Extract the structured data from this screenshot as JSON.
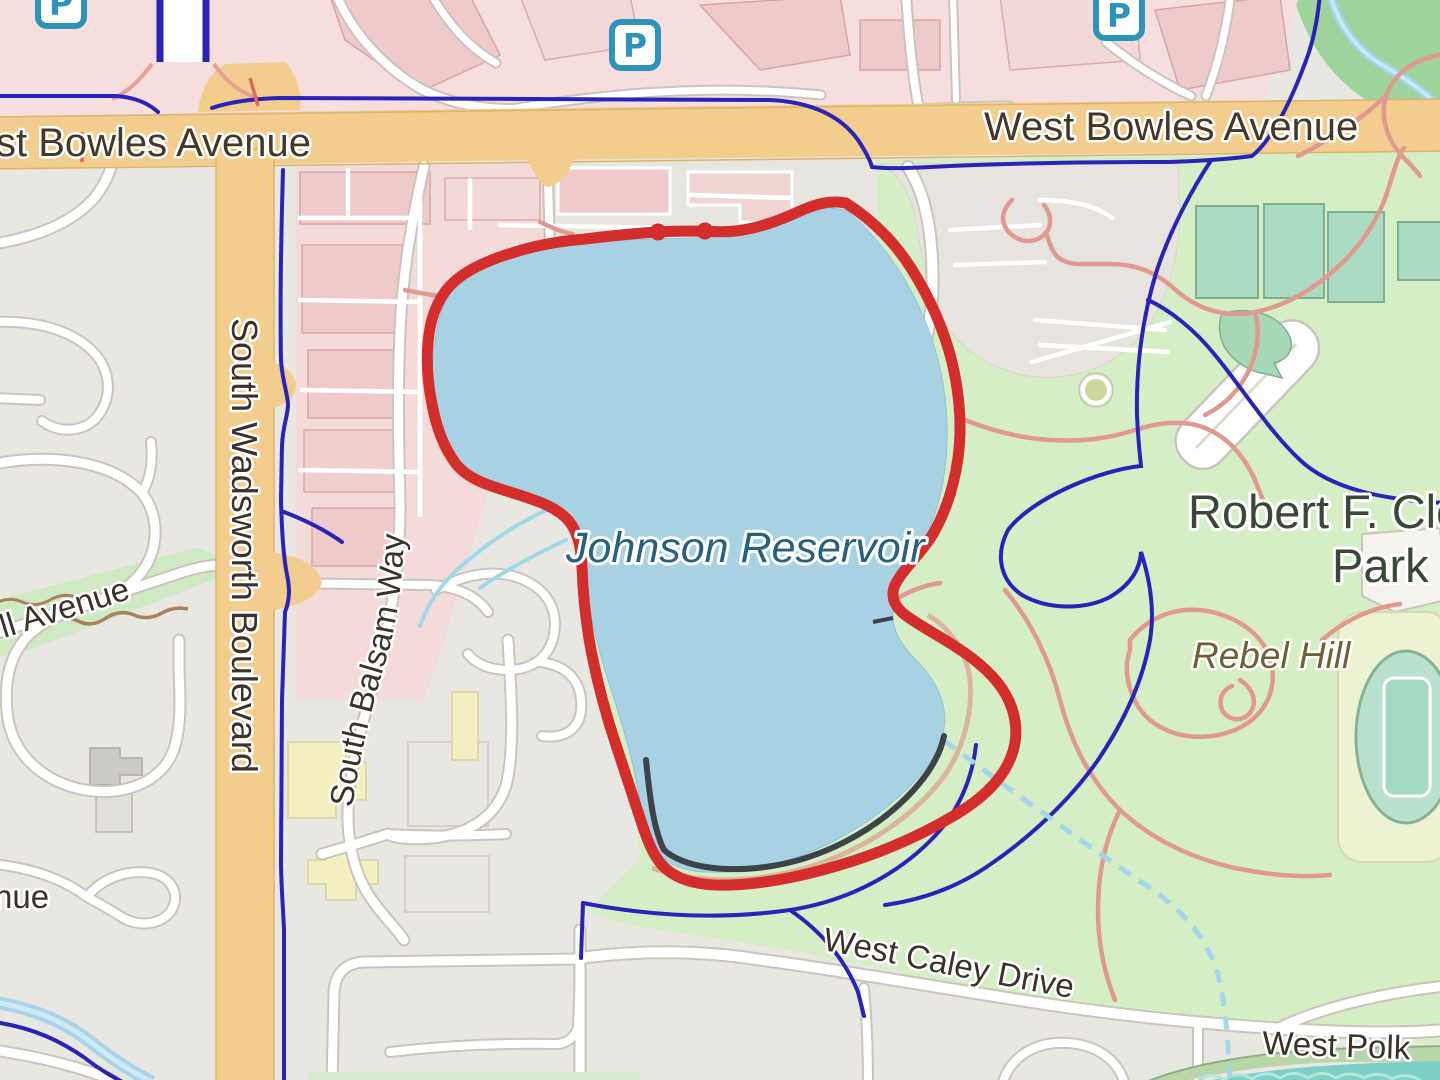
{
  "labels": {
    "bowles_left": "st Bowles Avenue",
    "bowles_right": "West Bowles Avenue",
    "wadsworth": "South Wadsworth Boulevard",
    "balsam": "South Balsam Way",
    "reservoir": "Johnson Reservoir",
    "park_name_line1": "Robert F. Cle",
    "park_name_line2": "Park",
    "rebel_hill": "Rebel Hill",
    "caley": "West Caley Drive",
    "polk": "West Polk",
    "hill_avenue": "ll Avenue",
    "avenue_fragment": "nue"
  },
  "icons": {
    "parking": "P"
  },
  "colors": {
    "route": "#d32d2c",
    "water": "#a8d2e4",
    "park_green": "#d6eec6",
    "road_primary": "#f2cd8e",
    "cycleway": "#2a23b8",
    "trail": "#e0998f",
    "water_label": "#27617e",
    "parking_icon": "#2e93bb"
  }
}
